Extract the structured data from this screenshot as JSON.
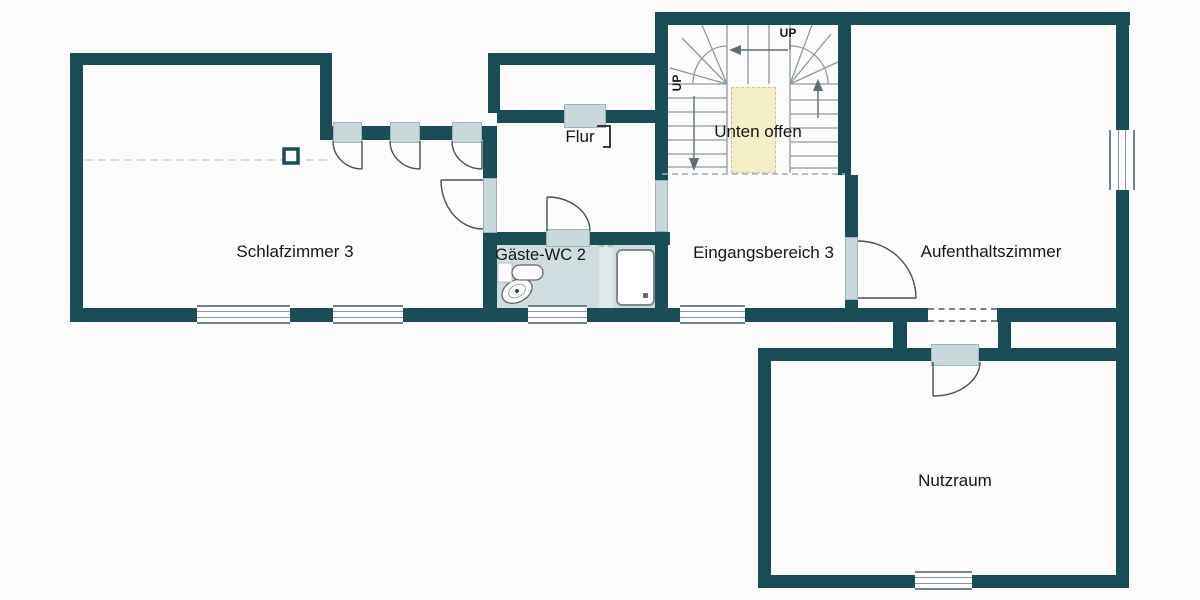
{
  "plan": {
    "rooms": [
      {
        "name": "schlafzimmer-3",
        "label": "Schlafzimmer 3"
      },
      {
        "name": "flur",
        "label": "Flur"
      },
      {
        "name": "gaeste-wc-2",
        "label": "Gäste-WC 2"
      },
      {
        "name": "eingangsbereich-3",
        "label": "Eingangsbereich 3"
      },
      {
        "name": "aufenthaltszimmer",
        "label": "Aufenthaltszimmer"
      },
      {
        "name": "nutzraum",
        "label": "Nutzraum"
      }
    ],
    "stairs": {
      "open_below_label": "Unten offen",
      "up_label_top": "UP",
      "up_label_left": "UP"
    },
    "colors": {
      "wall": "#1b4d57",
      "opening": "#c8d8db",
      "wc_floor": "#cfdde0",
      "open_below_fill": "#f4eec6",
      "background": "#fcfcfc",
      "text": "#161616"
    }
  }
}
